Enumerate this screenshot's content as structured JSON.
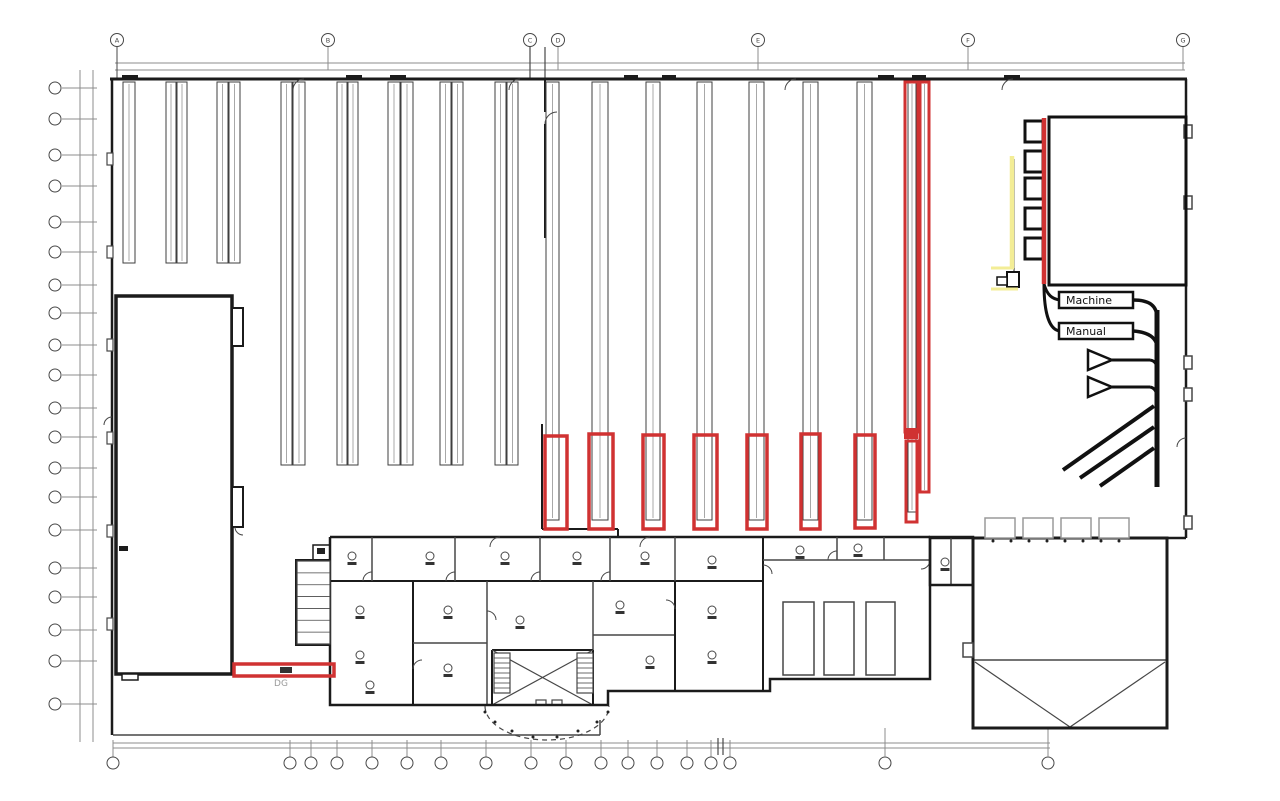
{
  "meta": {
    "width": 1280,
    "height": 801,
    "background": "#ffffff"
  },
  "palette": {
    "w": "#1b1b1b",
    "k": "#111111",
    "t": "#474747",
    "d": "#8c8c8c",
    "r": "#d03232",
    "y": "#f3ed96",
    "g": "#9a9a9a",
    "rk": "#3f3f3f",
    "rl": "#a8a8a8"
  },
  "labels": {
    "machine": "Machine",
    "manual": "Manual",
    "dg": "DG"
  },
  "grid": {
    "top": {
      "circle_y": 40,
      "r": 6.5,
      "xs": [
        117,
        328,
        530,
        558,
        758,
        968,
        1183
      ],
      "labels": [
        "A",
        "B",
        "C",
        "D",
        "E",
        "F",
        "G"
      ]
    },
    "left": {
      "circle_x": 55,
      "r": 6,
      "ys": [
        88,
        119,
        155,
        186,
        222,
        252,
        285,
        313,
        345,
        375,
        408,
        437,
        468,
        497,
        530,
        568,
        597,
        630,
        661,
        704
      ]
    },
    "bottom": {
      "circle_y": 763,
      "r": 6,
      "xs": [
        113,
        290,
        311,
        337,
        372,
        407,
        441,
        486,
        531,
        566,
        601,
        628,
        657,
        687,
        711,
        730,
        885,
        1048
      ]
    }
  },
  "racks": {
    "groups": [
      {
        "y1": 82,
        "y2": 263,
        "cols": [
          [
            123,
            12
          ],
          [
            166,
            10
          ],
          [
            177,
            10
          ],
          [
            217,
            11
          ],
          [
            229,
            11
          ]
        ]
      },
      {
        "y1": 82,
        "y2": 465,
        "cols": [
          [
            281,
            11
          ],
          [
            293,
            12
          ],
          [
            337,
            10
          ],
          [
            348,
            10
          ],
          [
            388,
            12
          ],
          [
            401,
            12
          ],
          [
            440,
            11
          ],
          [
            452,
            11
          ],
          [
            495,
            11
          ],
          [
            507,
            11
          ]
        ]
      },
      {
        "y1": 82,
        "y2": 520,
        "cols": [
          [
            546,
            13
          ],
          [
            592,
            16
          ],
          [
            646,
            14
          ],
          [
            697,
            15
          ],
          [
            749,
            15
          ],
          [
            803,
            15
          ],
          [
            857,
            15
          ]
        ]
      },
      {
        "y1": 82,
        "y2": 512,
        "cols": [
          [
            908,
            8
          ]
        ]
      },
      {
        "y1": 82,
        "y2": 492,
        "cols": [
          [
            921,
            7
          ]
        ]
      }
    ]
  },
  "red": {
    "boxes": [
      [
        545,
        436,
        22,
        93
      ],
      [
        589,
        434,
        24,
        95
      ],
      [
        643,
        435,
        21,
        94
      ],
      [
        694,
        435,
        23,
        94
      ],
      [
        747,
        435,
        20,
        94
      ],
      [
        801,
        434,
        19,
        95
      ],
      [
        855,
        435,
        20,
        93
      ]
    ],
    "tall": [
      [
        905,
        82,
        13,
        350
      ],
      [
        920,
        82,
        9,
        410
      ],
      [
        906,
        441,
        11,
        81
      ]
    ],
    "joint": [
      904,
      428,
      14,
      11
    ],
    "bar": [
      234,
      664,
      100,
      12
    ],
    "bar_mark": [
      280,
      667,
      12,
      6
    ],
    "feed_line": [
      1044,
      118,
      1044,
      284
    ]
  },
  "lines": [
    [
      115,
      63,
      1185,
      63,
      "d",
      1
    ],
    [
      115,
      70,
      1185,
      70,
      "d",
      1
    ],
    [
      80,
      70,
      80,
      742,
      "d",
      1
    ],
    [
      93,
      70,
      93,
      742,
      "d",
      1
    ],
    [
      113,
      743,
      1050,
      743,
      "d",
      1
    ],
    [
      113,
      748,
      1050,
      748,
      "d",
      1
    ],
    [
      113,
      735,
      600,
      735,
      "t",
      1.5
    ],
    [
      600,
      720,
      600,
      735,
      "t",
      1.5
    ],
    [
      117,
      47,
      117,
      79,
      "t",
      1
    ],
    [
      530,
      47,
      530,
      79,
      "t",
      1.2
    ],
    [
      545,
      47,
      545,
      79,
      "t",
      1.2
    ],
    [
      885,
      728,
      885,
      757,
      "d",
      1
    ],
    [
      1048,
      728,
      1048,
      757,
      "d",
      1
    ],
    [
      718,
      738,
      718,
      755,
      "t",
      1.2
    ],
    [
      723,
      738,
      723,
      755,
      "t",
      1.2
    ],
    [
      110,
      79,
      1187,
      79,
      "w",
      3
    ],
    [
      1186,
      79,
      1186,
      538,
      "w",
      2.5
    ],
    [
      930,
      538,
      1186,
      538,
      "w",
      2.5
    ],
    [
      112,
      79,
      112,
      735,
      "w",
      2.5
    ],
    [
      545,
      79,
      545,
      112,
      "w",
      2
    ],
    [
      545,
      124,
      545,
      238,
      "w",
      2
    ],
    [
      542,
      424,
      542,
      529,
      "w",
      2
    ],
    [
      542,
      529,
      618,
      529,
      "w",
      2
    ],
    [
      618,
      529,
      618,
      537,
      "w",
      2
    ],
    [
      116,
      503,
      232,
      503,
      "w",
      4
    ],
    [
      116,
      549,
      232,
      549,
      "w",
      2.5
    ],
    [
      116,
      575,
      232,
      575,
      "w",
      4
    ],
    [
      330,
      537,
      930,
      537,
      "w",
      2.5
    ],
    [
      330,
      581,
      763,
      581,
      "w",
      2
    ],
    [
      372,
      537,
      372,
      581,
      "t",
      1.5
    ],
    [
      455,
      537,
      455,
      581,
      "t",
      1.5
    ],
    [
      540,
      537,
      540,
      581,
      "t",
      1.5
    ],
    [
      610,
      537,
      610,
      581,
      "t",
      1.5
    ],
    [
      675,
      537,
      675,
      581,
      "t",
      1.5
    ],
    [
      413,
      581,
      413,
      705,
      "w",
      2
    ],
    [
      487,
      581,
      487,
      705,
      "t",
      1.5
    ],
    [
      413,
      643,
      487,
      643,
      "t",
      1.5
    ],
    [
      593,
      581,
      593,
      650,
      "t",
      1.5
    ],
    [
      593,
      635,
      675,
      635,
      "t",
      1.5
    ],
    [
      675,
      581,
      675,
      691,
      "w",
      2
    ],
    [
      763,
      537,
      763,
      691,
      "w",
      2
    ],
    [
      763,
      560,
      930,
      560,
      "t",
      1.5
    ],
    [
      837,
      537,
      837,
      560,
      "t",
      1.5
    ],
    [
      884,
      537,
      884,
      560,
      "t",
      1.5
    ],
    [
      951,
      537,
      951,
      585,
      "t",
      1.5
    ],
    [
      492,
      650,
      492,
      705,
      "w",
      2
    ],
    [
      593,
      650,
      593,
      705,
      "w",
      2
    ],
    [
      492,
      650,
      593,
      650,
      "w",
      2
    ],
    [
      492,
      650,
      593,
      705,
      "t",
      1.2
    ],
    [
      593,
      650,
      492,
      705,
      "t",
      1.2
    ],
    [
      973,
      660,
      1167,
      660,
      "t",
      1.5
    ],
    [
      975,
      662,
      1070,
      727,
      "t",
      1.2
    ],
    [
      1165,
      662,
      1070,
      727,
      "t",
      1.2
    ],
    [
      1157,
      310,
      1157,
      487,
      "k",
      5
    ],
    [
      1063,
      470,
      1154,
      406,
      "k",
      4
    ],
    [
      1080,
      478,
      1154,
      427,
      "k",
      4
    ],
    [
      1100,
      486,
      1154,
      448,
      "k",
      4
    ],
    [
      1112,
      360,
      1150,
      360,
      "k",
      3
    ],
    [
      1112,
      387,
      1150,
      387,
      "k",
      3
    ],
    [
      1012,
      156,
      1012,
      268,
      "y",
      4.5
    ],
    [
      991,
      268,
      1014,
      268,
      "y",
      3
    ],
    [
      991,
      289,
      1018,
      289,
      "y",
      3
    ],
    [
      1014,
      159,
      1014,
      272,
      "w",
      1
    ]
  ],
  "rects": [
    [
      116,
      296,
      116,
      378,
      "w",
      3.5,
      "#ffffff"
    ],
    [
      232,
      308,
      11,
      38,
      "w",
      2,
      "#ffffff"
    ],
    [
      232,
      487,
      11,
      40,
      "w",
      2,
      "#ffffff"
    ],
    [
      122,
      674,
      16,
      6,
      "w",
      1.5,
      "#ffffff"
    ],
    [
      107,
      153,
      6,
      12,
      "t",
      1.2,
      "#ffffff"
    ],
    [
      107,
      246,
      6,
      12,
      "t",
      1.2,
      "#ffffff"
    ],
    [
      107,
      339,
      6,
      12,
      "t",
      1.2,
      "#ffffff"
    ],
    [
      107,
      432,
      6,
      12,
      "t",
      1.2,
      "#ffffff"
    ],
    [
      107,
      525,
      6,
      12,
      "t",
      1.2,
      "#ffffff"
    ],
    [
      107,
      618,
      6,
      12,
      "t",
      1.2,
      "#ffffff"
    ],
    [
      1184,
      125,
      8,
      13,
      "t",
      1.5,
      "#ffffff"
    ],
    [
      1184,
      196,
      8,
      13,
      "t",
      1.5,
      "#ffffff"
    ],
    [
      1184,
      356,
      8,
      13,
      "t",
      1.5,
      "#ffffff"
    ],
    [
      1184,
      388,
      8,
      13,
      "t",
      1.5,
      "#ffffff"
    ],
    [
      1184,
      516,
      8,
      13,
      "t",
      1.5,
      "#ffffff"
    ],
    [
      1049,
      117,
      137,
      168,
      "k",
      3,
      "none"
    ],
    [
      1025,
      121,
      18,
      21,
      "k",
      3,
      "#ffffff"
    ],
    [
      1025,
      151,
      18,
      21,
      "k",
      3,
      "#ffffff"
    ],
    [
      1025,
      178,
      18,
      21,
      "k",
      3,
      "#ffffff"
    ],
    [
      1025,
      208,
      18,
      21,
      "k",
      3,
      "#ffffff"
    ],
    [
      1025,
      238,
      18,
      21,
      "k",
      3,
      "#ffffff"
    ],
    [
      1007,
      272,
      12,
      15,
      "k",
      2,
      "#ffffff"
    ],
    [
      997,
      277,
      10,
      8,
      "k",
      1.5,
      "#ffffff"
    ],
    [
      783,
      602,
      31,
      73,
      "t",
      1.5,
      "#ffffff"
    ],
    [
      824,
      602,
      30,
      73,
      "t",
      1.5,
      "#ffffff"
    ],
    [
      866,
      602,
      29,
      73,
      "t",
      1.5,
      "#ffffff"
    ],
    [
      930,
      537,
      43,
      48,
      "w",
      2.5,
      "none"
    ],
    [
      973,
      538,
      194,
      190,
      "w",
      3,
      "none"
    ],
    [
      963,
      643,
      10,
      14,
      "t",
      1.5,
      "#ffffff"
    ],
    [
      985,
      518,
      30,
      20,
      "g",
      1.5,
      "#ffffff"
    ],
    [
      1023,
      518,
      30,
      20,
      "g",
      1.5,
      "#ffffff"
    ],
    [
      1061,
      518,
      30,
      20,
      "g",
      1.5,
      "#ffffff"
    ],
    [
      1099,
      518,
      30,
      20,
      "g",
      1.5,
      "#ffffff"
    ],
    [
      313,
      545,
      17,
      15,
      "w",
      1.5,
      "#ffffff"
    ],
    [
      536,
      700,
      10,
      5,
      "t",
      1.2,
      "#ffffff"
    ],
    [
      552,
      700,
      10,
      5,
      "t",
      1.2,
      "#ffffff"
    ]
  ],
  "fills": [
    [
      122,
      75,
      16,
      5,
      "w"
    ],
    [
      346,
      75,
      16,
      5,
      "w"
    ],
    [
      390,
      75,
      16,
      5,
      "w"
    ],
    [
      624,
      75,
      14,
      5,
      "w"
    ],
    [
      662,
      75,
      14,
      5,
      "w"
    ],
    [
      878,
      75,
      16,
      5,
      "w"
    ],
    [
      912,
      75,
      14,
      5,
      "w"
    ],
    [
      1004,
      75,
      16,
      5,
      "w"
    ],
    [
      119,
      546,
      9,
      5,
      "w"
    ],
    [
      299,
      565,
      12,
      8,
      "#222222"
    ],
    [
      299,
      578,
      12,
      8,
      "#222222"
    ],
    [
      317,
      548,
      8,
      6,
      "#222222"
    ]
  ],
  "paths": [
    [
      "M293,90 A11,11 0 0 1 304,79",
      "t",
      1,
      "none"
    ],
    [
      "M509,90 A11,11 0 0 1 520,79",
      "t",
      1,
      "none"
    ],
    [
      "M785,90 A11,11 0 0 1 796,79",
      "t",
      1,
      "none"
    ],
    [
      "M1002,90 A11,11 0 0 1 1013,79",
      "t",
      1,
      "none"
    ],
    [
      "M545,124 A12,12 0 0 1 557,112",
      "t",
      1,
      "none"
    ],
    [
      "M1177,447 A9,9 0 0 1 1186,438",
      "t",
      1,
      "none"
    ],
    [
      "M243,535 A8,8 0 0 1 235,527",
      "t",
      1,
      "none"
    ],
    [
      "M104,425 A8,8 0 0 1 112,417",
      "t",
      1,
      "none"
    ],
    [
      "M372,572 A9,9 0 0 0 363,581",
      "t",
      1,
      "none"
    ],
    [
      "M455,572 A9,9 0 0 0 446,581",
      "t",
      1,
      "none"
    ],
    [
      "M540,572 A9,9 0 0 0 531,581",
      "t",
      1,
      "none"
    ],
    [
      "M610,572 A9,9 0 0 0 601,581",
      "t",
      1,
      "none"
    ],
    [
      "M422,660 A9,9 0 0 0 413,669",
      "t",
      1,
      "none"
    ],
    [
      "M487,611 A9,9 0 0 1 496,620",
      "t",
      1,
      "none"
    ],
    [
      "M675,609 A9,9 0 0 0 666,600",
      "t",
      1,
      "none"
    ],
    [
      "M763,565 A9,9 0 0 1 772,574",
      "t",
      1,
      "none"
    ],
    [
      "M837,551 A9,9 0 0 0 828,560",
      "t",
      1,
      "none"
    ],
    [
      "M930,560 A9,9 0 0 1 921,569",
      "t",
      1,
      "none"
    ],
    [
      "M490,547 A10,10 0 0 1 500,537",
      "t",
      1,
      "none"
    ],
    [
      "M640,547 A10,10 0 0 1 650,537",
      "t",
      1,
      "none"
    ],
    [
      "M330,537 L330,705 L608,705 L608,691 L770,691 L770,679 L930,679 L930,537",
      "w",
      2.5,
      "none"
    ],
    [
      "M296,560 L330,560 L330,645 L296,645 Z",
      "w",
      2,
      "#ffffff"
    ],
    [
      "M1044,284 C1047,295 1052,299 1060,300",
      "k",
      3,
      "none"
    ],
    [
      "M1044,284 C1044,312 1049,330 1060,331",
      "k",
      3,
      "none"
    ],
    [
      "M1133,300 C1150,300 1157,306 1157,318",
      "k",
      3.5,
      "none"
    ],
    [
      "M1133,331 C1148,332 1155,337 1157,345",
      "k",
      3.5,
      "none"
    ],
    [
      "M1150,360 C1156,361 1157,365 1157,372",
      "k",
      3,
      "none"
    ],
    [
      "M1150,387 C1155,388 1157,392 1157,398",
      "k",
      3,
      "none"
    ],
    [
      "M1088,350 L1088,370 L1112,360 Z",
      "k",
      2.5,
      "#ffffff"
    ],
    [
      "M1088,377 L1088,397 L1112,387 Z",
      "k",
      2.5,
      "#ffffff"
    ],
    [
      "M485,706 A62,34 0 0 0 609,706",
      "t",
      1.2,
      "none",
      "5,4"
    ]
  ],
  "stairs": [
    {
      "x": 494,
      "y": 653,
      "w": 16,
      "h": 40,
      "n": 8
    },
    {
      "x": 577,
      "y": 653,
      "w": 16,
      "h": 40,
      "n": 8
    },
    {
      "x": 297,
      "y": 561,
      "w": 33,
      "h": 83,
      "n": 7
    }
  ],
  "desks": [
    [
      352,
      556
    ],
    [
      430,
      556
    ],
    [
      505,
      556
    ],
    [
      577,
      556
    ],
    [
      645,
      556
    ],
    [
      712,
      560
    ],
    [
      360,
      610
    ],
    [
      360,
      655
    ],
    [
      370,
      685
    ],
    [
      448,
      610
    ],
    [
      448,
      668
    ],
    [
      520,
      620
    ],
    [
      620,
      605
    ],
    [
      650,
      660
    ],
    [
      712,
      610
    ],
    [
      712,
      655
    ],
    [
      800,
      550
    ],
    [
      858,
      548
    ],
    [
      945,
      562
    ]
  ],
  "dots": [
    [
      485,
      712
    ],
    [
      495,
      722
    ],
    [
      512,
      731
    ],
    [
      533,
      737
    ],
    [
      557,
      737
    ],
    [
      578,
      731
    ],
    [
      597,
      722
    ],
    [
      608,
      712
    ],
    [
      993,
      541
    ],
    [
      1011,
      541
    ],
    [
      1029,
      541
    ],
    [
      1047,
      541
    ],
    [
      1065,
      541
    ],
    [
      1083,
      541
    ],
    [
      1101,
      541
    ],
    [
      1119,
      541
    ]
  ],
  "label_boxes": {
    "machine": [
      1059,
      292,
      74,
      16
    ],
    "manual": [
      1059,
      323,
      74,
      16
    ]
  },
  "texts": [
    {
      "x": 281,
      "y": 686,
      "size": 9,
      "color": "g",
      "key": "dg"
    }
  ]
}
